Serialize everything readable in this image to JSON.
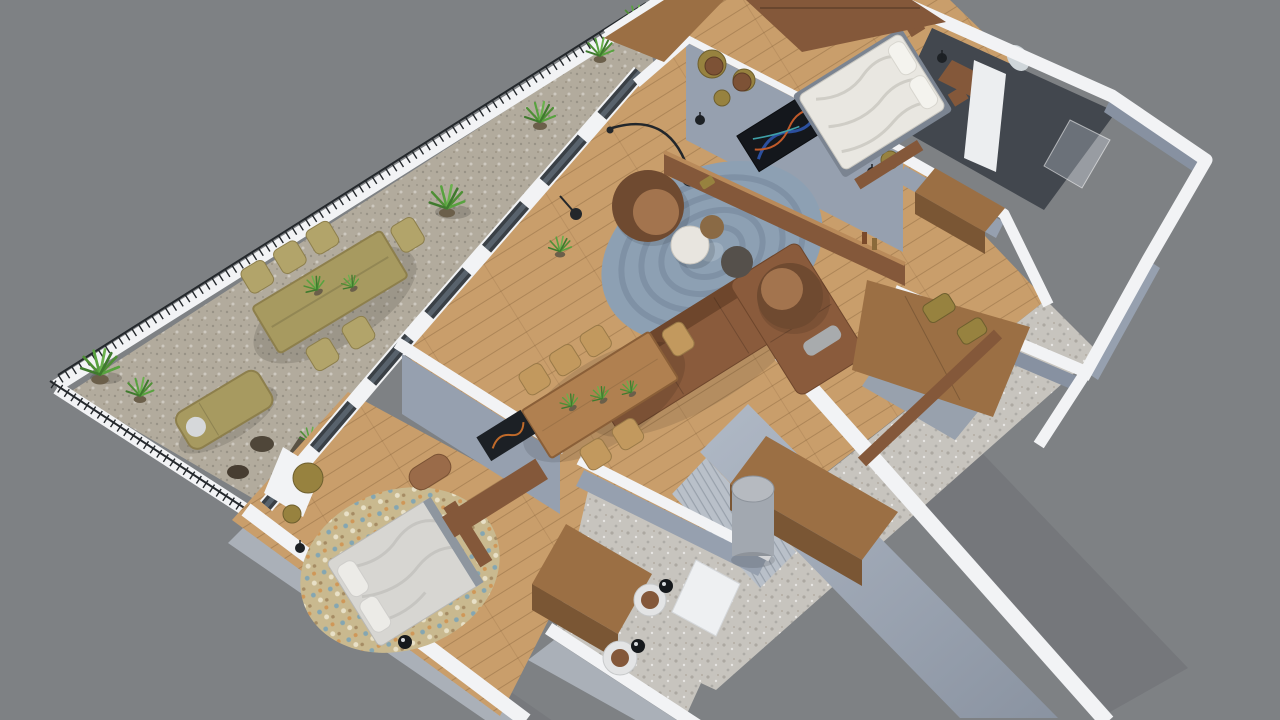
{
  "scene": {
    "type": "3d-floor-plan-render",
    "view": "isometric top-down cutaway",
    "subject": "apartment with wraparound terrace",
    "rooms": [
      "terrace",
      "living-room",
      "dining-area",
      "kitchen-cabinets",
      "master-bedroom",
      "master-bathroom",
      "walk-in-closet",
      "hallway",
      "second-bedroom",
      "entry-bathroom"
    ],
    "furniture": [
      "outdoor-wicker-dining-set",
      "sun-lounger",
      "potted-plants",
      "corner-sofa",
      "barrel-armchairs",
      "round-braided-rug",
      "coffee-tables",
      "arc-floor-lamp",
      "tv-partition-wall",
      "gold-wall-discs",
      "dining-table-with-chairs",
      "double-bed-white",
      "double-bed-silver",
      "speckled-round-rug",
      "wardrobes",
      "washbasin-stools",
      "column"
    ]
  },
  "colors": {
    "background": "#7e8184",
    "wall_top": "#f2f3f5",
    "wall_face": "#96a0af",
    "wall_face_dark": "#8791a1",
    "slab_edge": "#aab0b8",
    "railing": "#24282c",
    "wood_floor": "#c99e6b",
    "terrace_floor": "#b2ab9d",
    "terrazzo": "#c7c4be",
    "glass": "#3a4046",
    "rug": "#8da0b3",
    "rug_rings": "#71播8295",
    "rug_bed2": "#c9b98f",
    "sofa": "#8a5b3c",
    "bed_white": "#e9e7e1",
    "bed_silver": "#d7d6d2",
    "wicker": "#a79a60",
    "gold": "#97823f",
    "plant": "#58a23f",
    "table_wood": "#b08050",
    "wood_furniture": "#9b6f44",
    "wood_console": "#84583a",
    "column": "#a2a8b0",
    "bath_dark": "#42474e",
    "marble": "#e8e5df"
  }
}
